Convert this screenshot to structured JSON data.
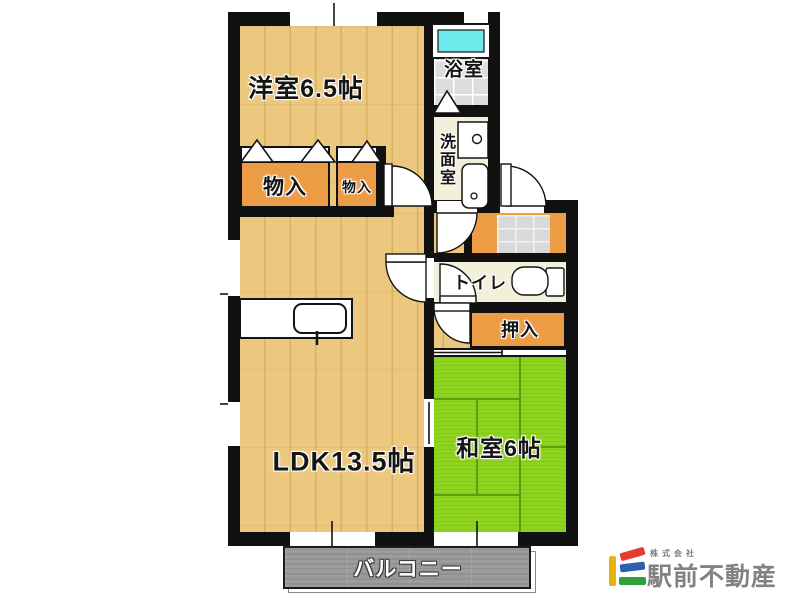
{
  "floorplan": {
    "rooms": {
      "western_room": {
        "label": "洋室6.5帖"
      },
      "bathroom": {
        "label": "浴室"
      },
      "washroom": {
        "label": "洗面室"
      },
      "storage_large": {
        "label": "物入"
      },
      "storage_small": {
        "label": "物入"
      },
      "toilet": {
        "label": "トイレ"
      },
      "closet": {
        "label": "押入"
      },
      "ldk": {
        "label": "LDK13.5帖"
      },
      "japanese_room": {
        "label": "和室6帖"
      },
      "balcony": {
        "label": "バルコニー"
      }
    }
  },
  "branding": {
    "company_prefix": "株式会社",
    "company_name": "駅前不動産"
  },
  "theme": {
    "wall": "#111111",
    "wood": "#ecc87f",
    "wood_line": "#d9af63",
    "closet_orange": "#ED9C46",
    "tatami": "#8DD320",
    "tatami_line": "#5d9e0e",
    "tile_gray": "#d9d9d9",
    "bath_tile": "#dcdcdc",
    "cream": "#f2efda",
    "tub_cyan": "#6FEAEC",
    "balcony_gray": "#9c9c9c",
    "logo_yellow": "#eab30c",
    "logo_red": "#e23b30",
    "logo_blue": "#2b62ae",
    "logo_green": "#2e9e3e",
    "logo_text": "#828282"
  }
}
